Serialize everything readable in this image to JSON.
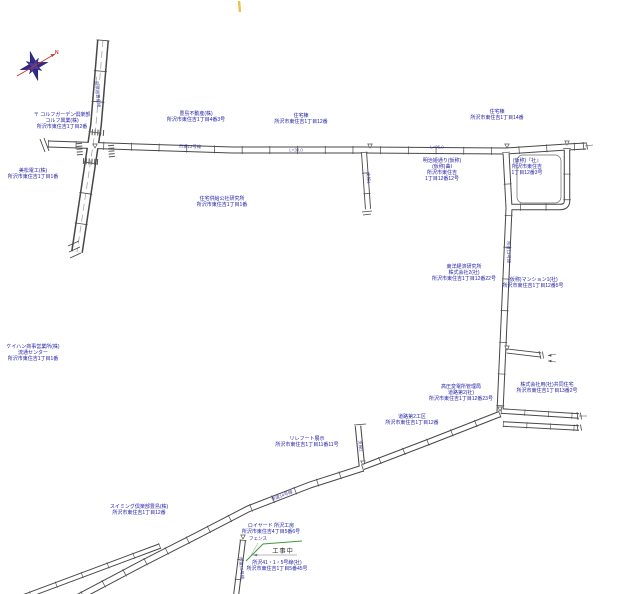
{
  "page": {
    "background": "#ffffff"
  },
  "compass": {
    "north_label": "N"
  },
  "construction": {
    "fence_label": "フェンス",
    "status_label": "工事中"
  },
  "colors": {
    "label_text": "#1a1aa6",
    "road_line": "#474747",
    "fence_green": "#3f9b3f",
    "compass_star": "#332a8c",
    "compass_needle": "#c0392b",
    "survey_tick_yellow": "#e6c34a"
  },
  "map": {
    "labels": [
      {
        "id": "garden-club",
        "x": 62,
        "y": 112,
        "lines": [
          "〒 コルフガーデン倶楽部",
          "コルフ興業(株)",
          "所沢市東住吉1丁目2番"
        ]
      },
      {
        "id": "toshima-fudosan",
        "x": 196,
        "y": 111,
        "lines": [
          "豊島不動産(株)",
          "所沢市東住吉1丁目4番3号"
        ]
      },
      {
        "id": "jutakuto-west",
        "x": 301,
        "y": 113,
        "lines": [
          "住宅棟",
          "所沢市東住吉1丁目12番"
        ]
      },
      {
        "id": "jutakuto-east",
        "x": 497,
        "y": 109,
        "lines": [
          "住宅棟",
          "所沢市東住吉1丁目14番"
        ]
      },
      {
        "id": "denko",
        "x": 33,
        "y": 168,
        "lines": [
          "美松電工(株)",
          "所沢市東住吉1丁目1番"
        ]
      },
      {
        "id": "kyokyu-kosha",
        "x": 222,
        "y": 196,
        "lines": [
          "住宅供給公社研究所",
          "所沢市東住吉1丁目1番"
        ]
      },
      {
        "id": "meiji-dori",
        "x": 442,
        "y": 158,
        "lines": [
          "明治姫通り(仮称)",
          "(仮称)曲I",
          "所沢市東住吉",
          "1丁目12番12号"
        ]
      },
      {
        "id": "kasho-yashiro",
        "x": 527,
        "y": 158,
        "lines": [
          "(仮称)『社』",
          "所沢市東住吉",
          "1丁目12番3号"
        ]
      },
      {
        "id": "toyo-keizai",
        "x": 464,
        "y": 264,
        "lines": [
          "東洋経済研究所",
          "株式会社2(社)",
          "所沢市東住吉1丁目12番22号"
        ]
      },
      {
        "id": "mansion",
        "x": 533,
        "y": 277,
        "lines": [
          "(仮称)マンション1(社)",
          "所沢市東住吉1丁目12番5号"
        ]
      },
      {
        "id": "hendensho",
        "x": 461,
        "y": 384,
        "lines": [
          "高圧変電所管理局",
          "道路第2(社)",
          "所沢市東住吉1丁目12番23号"
        ]
      },
      {
        "id": "kyodo-jutaku",
        "x": 547,
        "y": 382,
        "lines": [
          "株式会社用(社)共同住宅",
          "所沢市東住吉1丁目13番2号"
        ]
      },
      {
        "id": "doro-koku",
        "x": 412,
        "y": 414,
        "lines": [
          "道路第2工区",
          "所沢市東住吉1丁目12番"
        ]
      },
      {
        "id": "rirefuto",
        "x": 307,
        "y": 436,
        "lines": [
          "リレフート展示",
          "所沢市東住吉1丁目11番11号"
        ]
      },
      {
        "id": "keihan-shoji",
        "x": 33,
        "y": 344,
        "lines": [
          "ケイハン商事営業所(株)",
          "流通センター",
          "所沢市東住吉1丁目1番"
        ]
      },
      {
        "id": "royado-kobo",
        "x": 271,
        "y": 523,
        "lines": [
          "ロイヤード 所沢工房",
          "所沢市東住吉4丁目5番6号"
        ]
      },
      {
        "id": "swimming-club",
        "x": 139,
        "y": 504,
        "lines": [
          "スイミング倶楽部豊島(株)",
          "所沢市東住吉1丁目12番"
        ]
      },
      {
        "id": "gosen-line",
        "x": 277,
        "y": 560,
        "lines": [
          "所沢41・1・5号線(社)",
          "所沢市東住吉1丁目5番45号"
        ]
      }
    ],
    "road_names": [
      {
        "x": 97,
        "y": 92,
        "rot": 85,
        "text": "一般県道豊島線"
      },
      {
        "x": 190,
        "y": 147,
        "rot": 1,
        "text": "市道12号線"
      },
      {
        "x": 296,
        "y": 150,
        "rot": 1,
        "text": "L=30.0"
      },
      {
        "x": 437,
        "y": 147,
        "rot": 1,
        "text": "L=96.0"
      },
      {
        "x": 368,
        "y": 178,
        "rot": 88,
        "text": "支線1"
      },
      {
        "x": 508,
        "y": 252,
        "rot": 88,
        "text": "市道13号線"
      },
      {
        "x": 360,
        "y": 446,
        "rot": 85,
        "text": "支線2"
      },
      {
        "x": 282,
        "y": 496,
        "rot": -21,
        "text": "市道14号線"
      },
      {
        "x": 241,
        "y": 568,
        "rot": 85,
        "text": "市道15号線"
      }
    ]
  }
}
